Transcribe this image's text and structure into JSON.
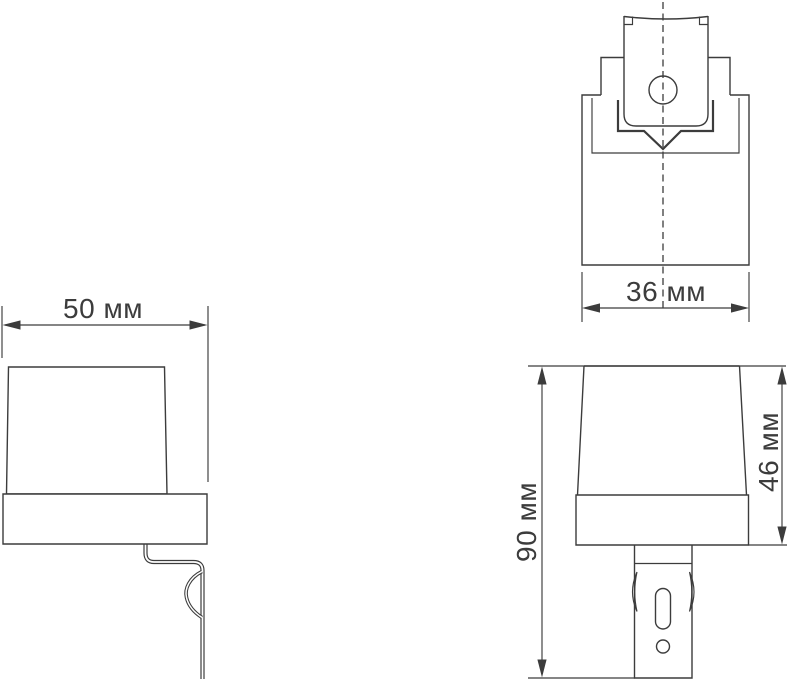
{
  "drawing": {
    "kind": "technical-dimension-drawing",
    "unit": "мм",
    "line_color": "#3c3c3c",
    "background_color": "#ffffff",
    "dimensions": {
      "side_width": {
        "label": "50 мм",
        "value": 50,
        "unit": "мм"
      },
      "top_width": {
        "label": "36 мм",
        "value": 36,
        "unit": "мм"
      },
      "front_total_height": {
        "label": "90 мм",
        "value": 90,
        "unit": "мм"
      },
      "front_head_height": {
        "label": "46 мм",
        "value": 46,
        "unit": "мм"
      }
    }
  }
}
